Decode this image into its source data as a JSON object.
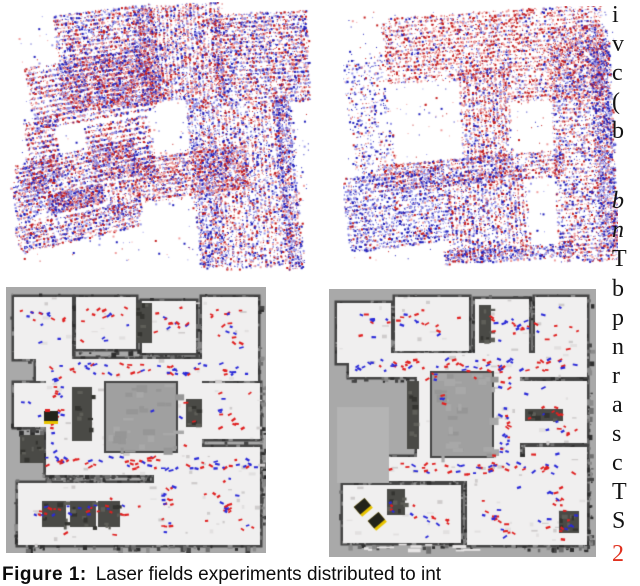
{
  "figure": {
    "caption": {
      "label": "Figure 1:",
      "text": "Laser fields experiments distributed to int"
    },
    "panel_descriptions": {
      "top_left": "3D laser point cloud of building complex, dense red and blue points, slightly rotated",
      "top_right": "3D laser point cloud of same complex, sparser, red-dominant top and blue-dominant bottom",
      "bottom_left": "2D occupancy grid map with red/blue measurement dashes and one robot marker",
      "bottom_right": "2D occupancy grid map with red/blue measurement dashes and two robot markers"
    }
  },
  "right_column": {
    "lines": [
      {
        "t": "i",
        "y": 2
      },
      {
        "t": "v",
        "y": 31
      },
      {
        "t": "c",
        "y": 60
      },
      {
        "t": "(",
        "y": 89
      },
      {
        "t": "b",
        "y": 118
      },
      {
        "t": "b",
        "y": 188,
        "it": true
      },
      {
        "t": "n",
        "y": 217,
        "it": true
      },
      {
        "t": "T",
        "y": 246
      },
      {
        "t": "b",
        "y": 276
      },
      {
        "t": "p",
        "y": 305
      },
      {
        "t": "n",
        "y": 334
      },
      {
        "t": "r",
        "y": 363
      },
      {
        "t": "a",
        "y": 392
      },
      {
        "t": "s",
        "y": 421
      },
      {
        "t": "c",
        "y": 450
      },
      {
        "t": "T",
        "y": 479
      },
      {
        "t": "S",
        "y": 508
      },
      {
        "t": "2",
        "y": 541,
        "ref": true
      }
    ]
  },
  "colors": {
    "page_bg": "#ffffff",
    "text": "#131313",
    "ref_red": "#e0301e",
    "cloud_red": "#c41f1f",
    "cloud_red_light": "#ef9f9f",
    "cloud_blue": "#2121bb",
    "cloud_blue_light": "#9898e8",
    "map_bg": "#a9a9a9",
    "floor": "#f0efef",
    "wall": "#454545",
    "courtyard": "#a0a0a0",
    "dot_red": "#e02020",
    "dot_blue": "#2a2ad8",
    "robot_yellow": "#e8c400",
    "robot_dark": "#23231a"
  },
  "panels": [
    {
      "canvas": "pointcloud-top-left",
      "type": "cloud",
      "seed": 7,
      "patches": [
        {
          "x": 50,
          "y": 6,
          "w": 100,
          "h": 100,
          "rot": -7,
          "density": 0.32,
          "red": 0.5,
          "stripe": "h",
          "step": 4
        },
        {
          "x": 130,
          "y": 2,
          "w": 85,
          "h": 95,
          "rot": -4,
          "density": 0.3,
          "red": 0.52,
          "stripe": "v",
          "step": 4
        },
        {
          "x": 205,
          "y": 10,
          "w": 95,
          "h": 90,
          "rot": -3,
          "density": 0.3,
          "red": 0.5,
          "stripe": "h",
          "step": 4
        },
        {
          "x": 20,
          "y": 55,
          "w": 125,
          "h": 62,
          "rot": -10,
          "density": 0.28,
          "red": 0.52,
          "stripe": "h",
          "step": 5
        },
        {
          "x": 20,
          "y": 118,
          "w": 30,
          "h": 62,
          "rot": -10,
          "density": 0.28,
          "red": 0.5,
          "stripe": "h",
          "step": 5
        },
        {
          "x": 80,
          "y": 118,
          "w": 65,
          "h": 62,
          "rot": -10,
          "density": 0.28,
          "red": 0.55,
          "stripe": "h",
          "step": 5
        },
        {
          "x": 185,
          "y": 95,
          "w": 25,
          "h": 170,
          "rot": -5,
          "density": 0.3,
          "red": 0.35,
          "stripe": "v",
          "step": 3
        },
        {
          "x": 208,
          "y": 100,
          "w": 70,
          "h": 165,
          "rot": -5,
          "density": 0.2,
          "red": 0.5,
          "stripe": "v",
          "step": 4
        },
        {
          "x": 272,
          "y": 92,
          "w": 16,
          "h": 175,
          "rot": -5,
          "density": 0.38,
          "red": 0.3,
          "stripe": "v",
          "step": 3
        },
        {
          "x": 125,
          "y": 148,
          "w": 115,
          "h": 45,
          "rot": -7,
          "density": 0.33,
          "red": 0.6,
          "stripe": "h",
          "step": 4
        },
        {
          "x": 7,
          "y": 148,
          "w": 122,
          "h": 35,
          "rot": -13,
          "density": 0.3,
          "red": 0.5,
          "stripe": "h",
          "step": 4
        },
        {
          "x": 7,
          "y": 210,
          "w": 125,
          "h": 28,
          "rot": -13,
          "density": 0.3,
          "red": 0.48,
          "stripe": "h",
          "step": 4
        },
        {
          "x": 5,
          "y": 178,
          "w": 38,
          "h": 38,
          "rot": -13,
          "density": 0.28,
          "red": 0.45,
          "stripe": "h",
          "step": 4
        },
        {
          "x": 97,
          "y": 180,
          "w": 35,
          "h": 35,
          "rot": -13,
          "density": 0.28,
          "red": 0.5,
          "stripe": "v",
          "step": 4
        },
        {
          "x": 40,
          "y": 186,
          "w": 55,
          "h": 20,
          "rot": -13,
          "density": 0.75,
          "red": 0.5,
          "stripe": "h",
          "step": 3
        },
        {
          "x": 10,
          "y": 10,
          "w": 290,
          "h": 250,
          "rot": 0,
          "density": 0.008,
          "red": 0.45
        }
      ]
    },
    {
      "canvas": "pointcloud-top-right",
      "type": "cloud",
      "seed": 11,
      "patches": [
        {
          "x": 40,
          "y": 5,
          "w": 220,
          "h": 65,
          "rot": -4,
          "density": 0.22,
          "red": 0.72,
          "stripe": "h",
          "step": 4
        },
        {
          "x": 5,
          "y": 50,
          "w": 42,
          "h": 125,
          "rot": -9,
          "density": 0.1,
          "red": 0.3,
          "stripe": "h",
          "step": 4
        },
        {
          "x": 118,
          "y": 62,
          "w": 48,
          "h": 95,
          "rot": -3,
          "density": 0.26,
          "red": 0.6,
          "stripe": "v",
          "step": 4
        },
        {
          "x": 160,
          "y": 68,
          "w": 100,
          "h": 25,
          "rot": -3,
          "density": 0.24,
          "red": 0.6,
          "stripe": "h",
          "step": 4
        },
        {
          "x": 40,
          "y": 150,
          "w": 180,
          "h": 28,
          "rot": -5,
          "density": 0.26,
          "red": 0.55,
          "stripe": "h",
          "step": 4
        },
        {
          "x": 210,
          "y": 20,
          "w": 60,
          "h": 235,
          "rot": -3,
          "density": 0.2,
          "red": 0.5,
          "stripe": "h",
          "step": 4
        },
        {
          "x": 252,
          "y": 35,
          "w": 18,
          "h": 205,
          "rot": -3,
          "density": 0.3,
          "red": 0.3,
          "stripe": "v",
          "step": 3
        },
        {
          "x": 2,
          "y": 165,
          "w": 105,
          "h": 75,
          "rot": -7,
          "density": 0.24,
          "red": 0.22,
          "stripe": "h",
          "step": 4
        },
        {
          "x": 105,
          "y": 162,
          "w": 78,
          "h": 90,
          "rot": -4,
          "density": 0.22,
          "red": 0.45,
          "stripe": "v",
          "step": 4
        },
        {
          "x": 100,
          "y": 240,
          "w": 130,
          "h": 14,
          "rot": -4,
          "density": 0.3,
          "red": 0.3,
          "stripe": "h",
          "step": 3
        },
        {
          "x": 5,
          "y": 5,
          "w": 265,
          "h": 250,
          "rot": 0,
          "density": 0.006,
          "red": 0.5
        }
      ]
    },
    {
      "canvas": "map-bottom-left",
      "type": "map",
      "seed": 21,
      "rooms": [
        [
          8,
          10,
          58,
          62
        ],
        [
          70,
          10,
          60,
          52
        ],
        [
          136,
          14,
          54,
          52
        ],
        [
          196,
          10,
          56,
          62
        ],
        [
          30,
          72,
          222,
          22
        ],
        [
          40,
          72,
          24,
          116
        ],
        [
          8,
          96,
          34,
          44
        ],
        [
          64,
          94,
          122,
          94
        ],
        [
          170,
          94,
          26,
          94
        ],
        [
          192,
          96,
          62,
          56
        ],
        [
          40,
          164,
          214,
          24
        ],
        [
          196,
          160,
          58,
          90
        ],
        [
          12,
          196,
          136,
          62
        ],
        [
          148,
          186,
          28,
          72
        ],
        [
          176,
          188,
          78,
          70
        ]
      ],
      "courtyards": [
        [
          100,
          96,
          70,
          68
        ]
      ],
      "dark_blocks": [
        [
          36,
          214,
          24,
          26
        ],
        [
          64,
          214,
          26,
          26
        ],
        [
          92,
          214,
          22,
          26
        ],
        [
          130,
          16,
          16,
          40
        ],
        [
          66,
          100,
          20,
          54
        ],
        [
          180,
          112,
          16,
          28
        ],
        [
          14,
          148,
          24,
          28
        ]
      ],
      "gray_patches": [],
      "wisps": [],
      "paths": [
        [
          [
            40,
            82
          ],
          [
            245,
            82
          ]
        ],
        [
          [
            52,
            84
          ],
          [
            52,
            174
          ]
        ],
        [
          [
            40,
            176
          ],
          [
            250,
            176
          ]
        ],
        [
          [
            162,
            176
          ],
          [
            162,
            248
          ]
        ],
        [
          [
            30,
            224
          ],
          [
            140,
            224
          ]
        ],
        [
          [
            208,
            20
          ],
          [
            244,
            62
          ]
        ],
        [
          [
            18,
            28
          ],
          [
            60,
            36
          ]
        ],
        [
          [
            86,
            28
          ],
          [
            122,
            22
          ]
        ],
        [
          [
            150,
            28
          ],
          [
            182,
            40
          ]
        ],
        [
          [
            208,
            120
          ],
          [
            236,
            142
          ]
        ],
        [
          [
            200,
            200
          ],
          [
            242,
            240
          ]
        ]
      ],
      "scatter": 70,
      "robots": [
        {
          "x": 45,
          "y": 130,
          "rot": 0,
          "red_dot": true
        }
      ]
    },
    {
      "canvas": "map-bottom-right",
      "type": "map",
      "seed": 33,
      "rooms": [
        [
          8,
          14,
          54,
          60
        ],
        [
          66,
          8,
          74,
          54
        ],
        [
          146,
          10,
          54,
          56
        ],
        [
          206,
          8,
          52,
          62
        ],
        [
          20,
          64,
          238,
          24
        ],
        [
          88,
          64,
          94,
          118
        ],
        [
          163,
          64,
          28,
          128
        ],
        [
          190,
          92,
          68,
          62
        ],
        [
          196,
          158,
          62,
          98
        ],
        [
          56,
          168,
          202,
          24
        ],
        [
          14,
          196,
          118,
          58
        ],
        [
          138,
          192,
          58,
          64
        ],
        [
          202,
          198,
          56,
          56
        ]
      ],
      "courtyards": [
        [
          103,
          84,
          60,
          83
        ]
      ],
      "dark_blocks": [
        [
          78,
          92,
          12,
          68
        ],
        [
          150,
          16,
          12,
          38
        ],
        [
          196,
          120,
          38,
          12
        ],
        [
          58,
          200,
          18,
          26
        ],
        [
          230,
          222,
          20,
          22
        ]
      ],
      "gray_patches": [
        [
          8,
          118,
          52,
          76
        ]
      ],
      "wisps": [
        [
          28,
          254,
          108,
          8
        ]
      ],
      "paths": [
        [
          [
            30,
            76
          ],
          [
            250,
            76
          ]
        ],
        [
          [
            176,
            78
          ],
          [
            176,
            180
          ]
        ],
        [
          [
            64,
            180
          ],
          [
            254,
            180
          ]
        ],
        [
          [
            218,
            100
          ],
          [
            240,
            150
          ]
        ],
        [
          [
            36,
            30
          ],
          [
            100,
            30
          ]
        ],
        [
          [
            158,
            30
          ],
          [
            232,
            44
          ]
        ],
        [
          [
            56,
            216
          ],
          [
            120,
            232
          ]
        ],
        [
          [
            150,
            208
          ],
          [
            182,
            250
          ]
        ],
        [
          [
            228,
            196
          ],
          [
            240,
            250
          ]
        ],
        [
          [
            110,
            76
          ],
          [
            110,
            110
          ]
        ]
      ],
      "scatter": 70,
      "robots": [
        {
          "x": 34,
          "y": 218,
          "rot": -0.7,
          "red_dot": false
        },
        {
          "x": 48,
          "y": 232,
          "rot": -0.7,
          "red_dot": false
        }
      ]
    }
  ]
}
